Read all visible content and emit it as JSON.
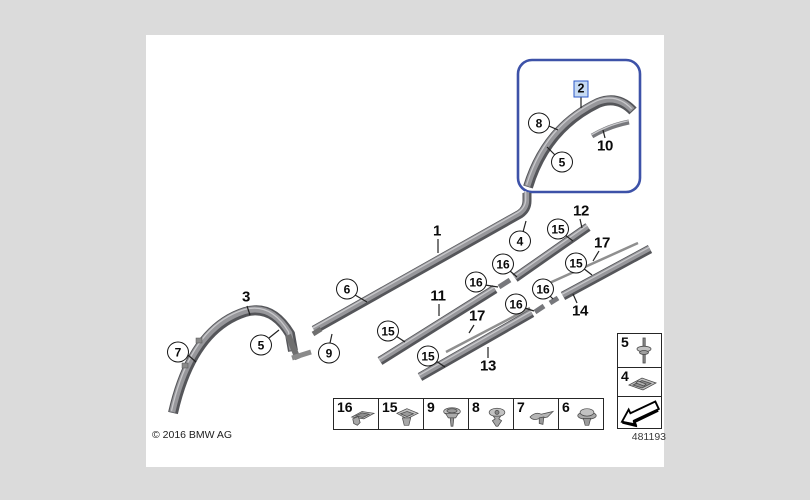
{
  "page": {
    "background": "#dbdbdb"
  },
  "canvas": {
    "copyright": "© 2016 BMW AG",
    "doc_number": "481193"
  },
  "selection": {
    "highlighted_part": "2",
    "box_color": "#3d52a8",
    "label_bg": "#c6daf3",
    "label_border": "#2d59c8"
  },
  "callouts": {
    "plain": [
      {
        "label": "1"
      },
      {
        "label": "3"
      },
      {
        "label": "11"
      },
      {
        "label": "17"
      },
      {
        "label": "13"
      },
      {
        "label": "12"
      },
      {
        "label": "17"
      },
      {
        "label": "14"
      },
      {
        "label": "10"
      }
    ],
    "circled": [
      {
        "label": "7"
      },
      {
        "label": "5"
      },
      {
        "label": "9"
      },
      {
        "label": "6"
      },
      {
        "label": "15"
      },
      {
        "label": "15"
      },
      {
        "label": "4"
      },
      {
        "label": "16"
      },
      {
        "label": "16"
      },
      {
        "label": "16"
      },
      {
        "label": "16"
      },
      {
        "label": "15"
      },
      {
        "label": "15"
      },
      {
        "label": "8"
      },
      {
        "label": "5"
      }
    ]
  },
  "legend": {
    "bottom_row": [
      {
        "label": "16",
        "icon": "flat-clip-icon"
      },
      {
        "label": "15",
        "icon": "pad-clip-icon"
      },
      {
        "label": "9",
        "icon": "expansion-rivet-icon"
      },
      {
        "label": "8",
        "icon": "grommet-pin-icon"
      },
      {
        "label": "7",
        "icon": "wing-clip-icon"
      },
      {
        "label": "6",
        "icon": "grommet-icon"
      }
    ],
    "side_column": [
      {
        "label": "5",
        "icon": "pin-washer-icon"
      },
      {
        "label": "4",
        "icon": "bracket-clip-icon"
      }
    ],
    "direction_arrow": "arrow-bottom-left-icon"
  }
}
